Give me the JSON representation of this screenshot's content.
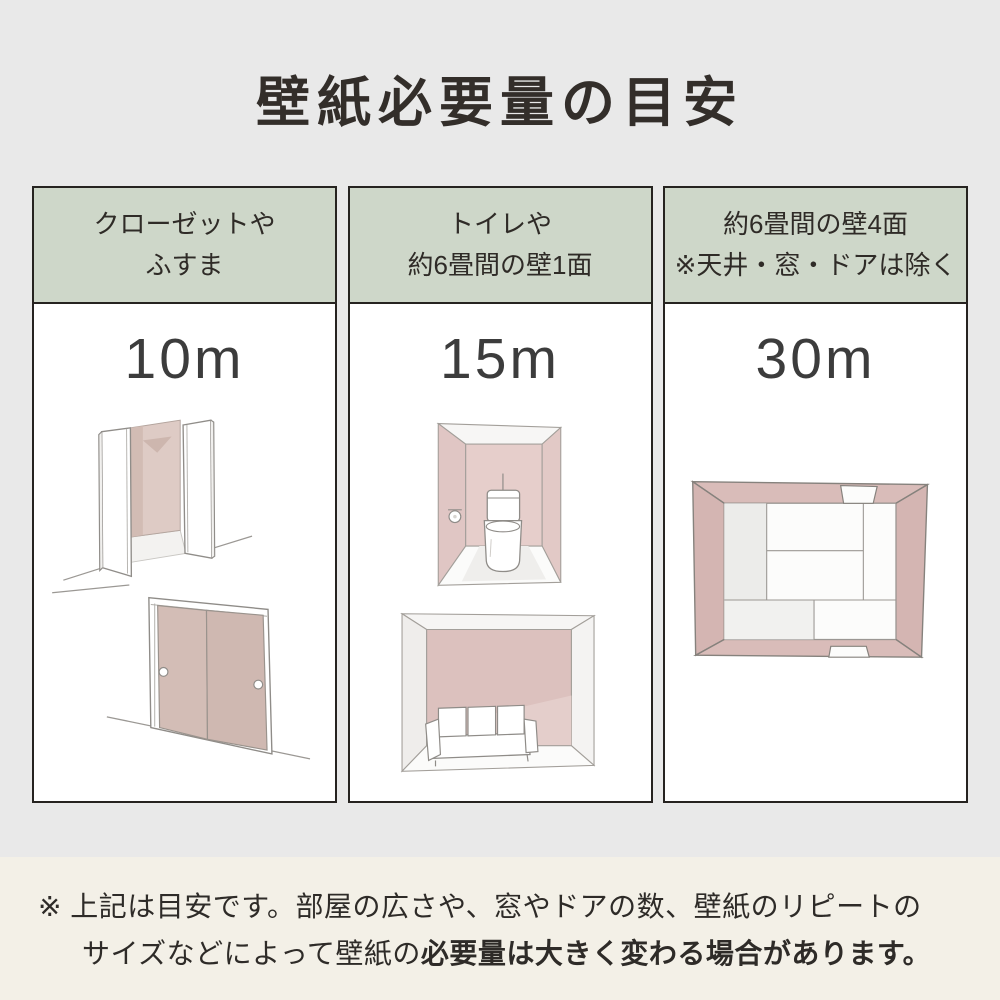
{
  "title": "壁紙必要量の目安",
  "cards": [
    {
      "header_line1": "クローゼットや",
      "header_line2": "ふすま",
      "value": "10m",
      "illustrations": [
        "open-closet",
        "fusuma-sliding-doors"
      ]
    },
    {
      "header_line1": "トイレや",
      "header_line2": "約6畳間の壁1面",
      "value": "15m",
      "illustrations": [
        "toilet-room",
        "room-with-sofa"
      ]
    },
    {
      "header_line1": "約6畳間の壁4面",
      "header_line2": "※天井・窓・ドアは除く",
      "value": "30m",
      "illustrations": [
        "tatami-room-top-view"
      ]
    }
  ],
  "footer": {
    "note_line1": "※ 上記は目安です。部屋の広さや、窓やドアの数、壁紙のリピートの",
    "note_line2_normal": "サイズなどによって壁紙の",
    "note_line2_bold": "必要量は大きく変わる場合があります。"
  },
  "colors": {
    "page_background": "#e9e9e9",
    "card_header_background": "#ced7c9",
    "card_background": "#ffffff",
    "card_border": "#262320",
    "footer_background": "#f3f0e7",
    "text": "#332e2a",
    "illustration_pink": "#dcc2bf",
    "fusuma_pink": "#d3bdb6"
  }
}
